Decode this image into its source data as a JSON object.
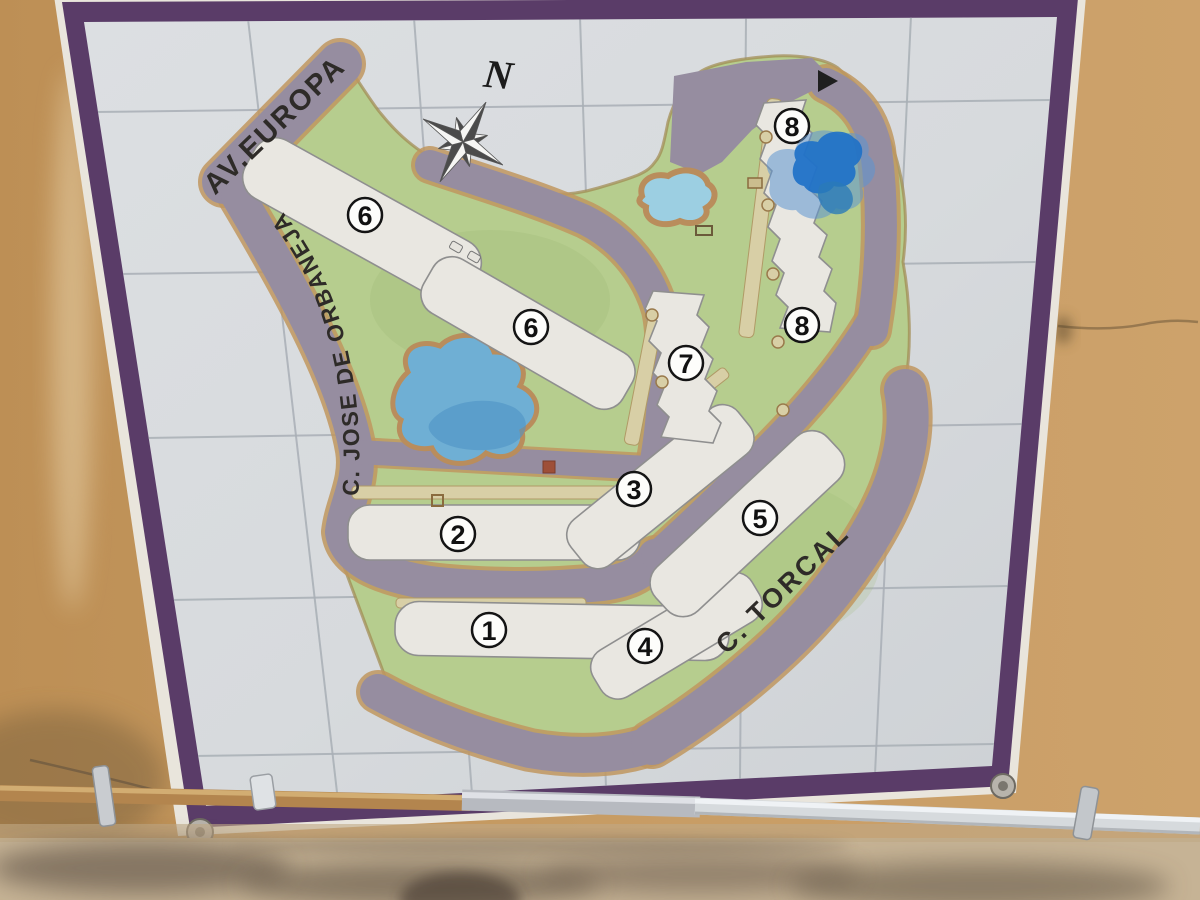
{
  "map": {
    "compass_label": "N",
    "streets": {
      "avenue": "AV.EUROPA",
      "left": "C. JOSE DE ORBANEJA",
      "torcal": "C. TORCAL"
    },
    "building_labels": [
      {
        "text": "1"
      },
      {
        "text": "2"
      },
      {
        "text": "3"
      },
      {
        "text": "4"
      },
      {
        "text": "5"
      },
      {
        "text": "6"
      },
      {
        "text": "6"
      },
      {
        "text": "7"
      },
      {
        "text": "8"
      },
      {
        "text": "8"
      }
    ]
  },
  "colors": {
    "frame_purple": "#5a3c68",
    "wall_tan": "#c49760",
    "tile_white": "#d8dbde",
    "grout_gray": "#a9afb6",
    "grass_green": "#b6cd8e",
    "road_gray": "#968da0",
    "road_edge_tan": "#bf965f",
    "building_white": "#e9e7e1",
    "pool_blue": "#9ccfe2",
    "lake_blue": "#6fafd4",
    "paint_marker_blue": "#1d70c8",
    "label_ink": "#2e2b28"
  }
}
